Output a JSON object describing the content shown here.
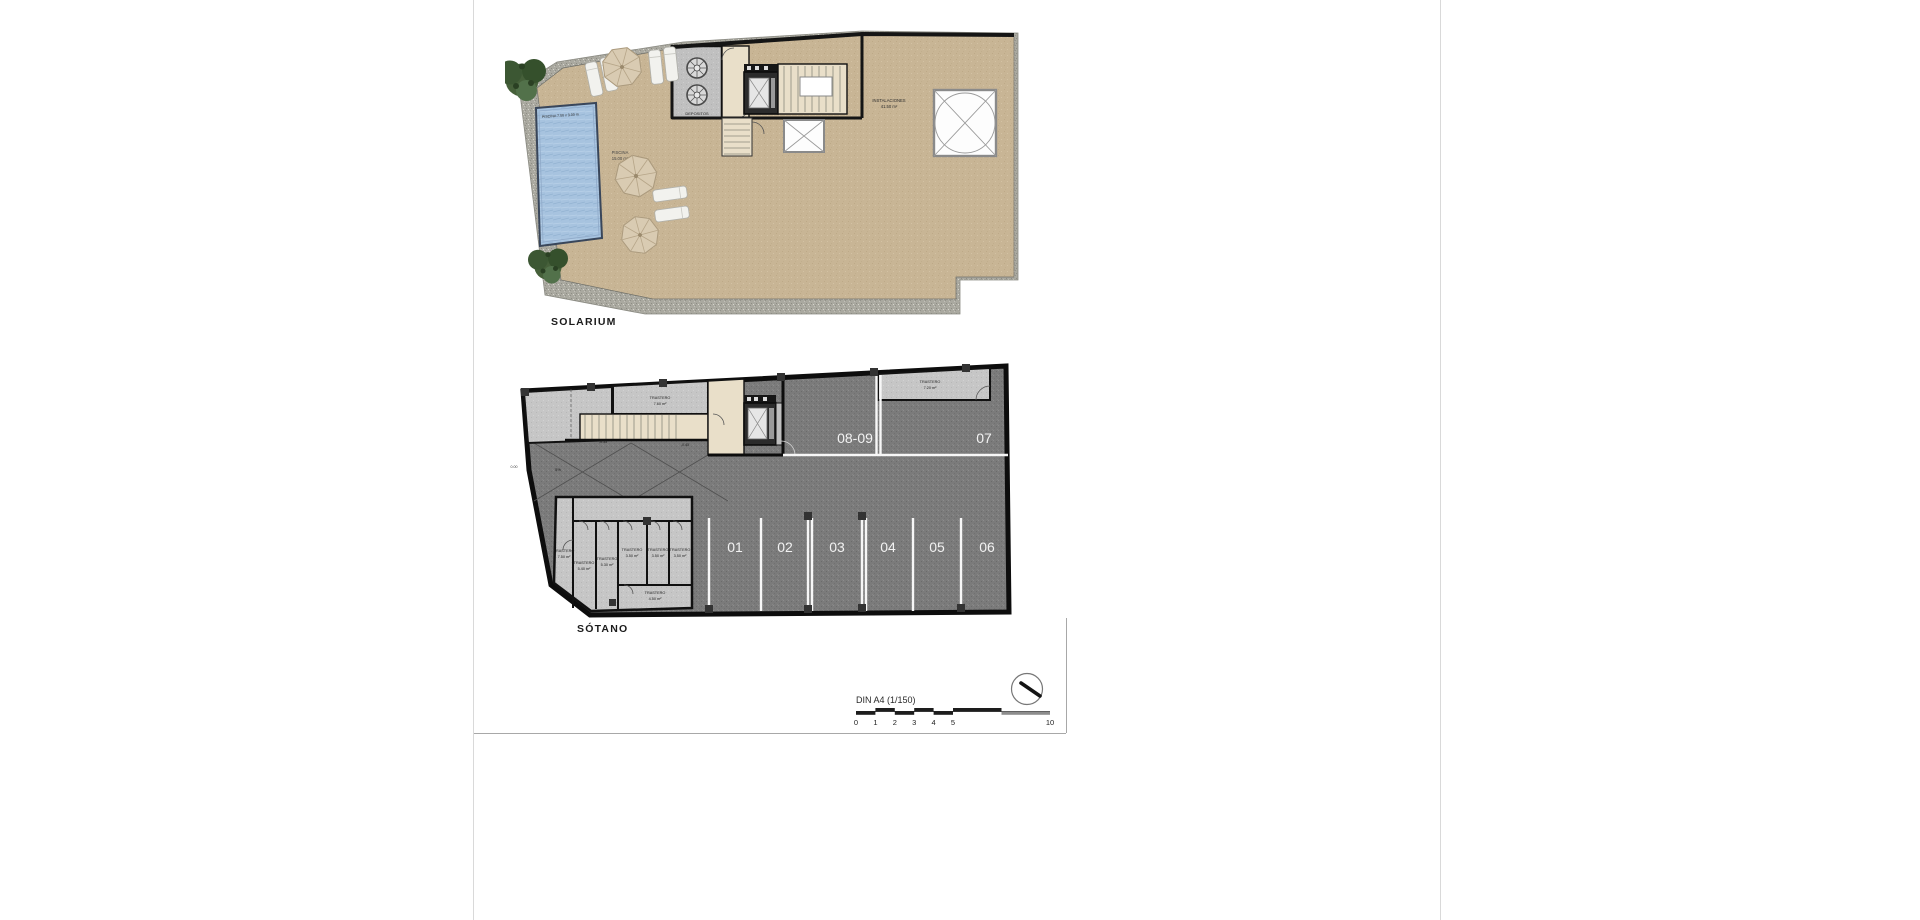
{
  "titles": {
    "solarium": "SOLARIUM",
    "sotano": "SÓTANO"
  },
  "solarium": {
    "pool_dim": "PISCINA 7.00 x 3.00 m",
    "pool_name": "PISCINA",
    "pool_area": "15.00 m²",
    "depositos": "DEPOSITOS",
    "instalaciones_name": "INSTALACIONES",
    "instalaciones_area": "41.50 m²"
  },
  "sotano": {
    "parking_top": [
      "08-09",
      "07"
    ],
    "parking": [
      "01",
      "02",
      "03",
      "04",
      "05",
      "06"
    ],
    "levels": {
      "l0": "0.00",
      "l35": "-0.35",
      "l45": "-0.45",
      "slope": "5%"
    },
    "rooms": {
      "t760": {
        "n": "TRASTERO",
        "a": "7.60 m²"
      },
      "t720": {
        "n": "TRASTERO",
        "a": "7.20 m²"
      },
      "t750": {
        "n": "TRASTERO",
        "a": "7.50 m²"
      },
      "t540": {
        "n": "TRASTERO",
        "a": "5.40 m²"
      },
      "t530": {
        "n": "TRASTERO",
        "a": "5.30 m²"
      },
      "t350a": {
        "n": "TRASTERO",
        "a": "3.50 m²"
      },
      "t350b": {
        "n": "TRASTERO",
        "a": "3.50 m²"
      },
      "t350c": {
        "n": "TRASTERO",
        "a": "3.50 m²"
      },
      "t450": {
        "n": "TRASTERO",
        "a": "4.50 m²"
      }
    }
  },
  "footer": {
    "scale_label": "DIN A4 (1/150)",
    "ticks": [
      "0",
      "1",
      "2",
      "3",
      "4",
      "5",
      "10"
    ]
  },
  "colors": {
    "terrace_tan": "#c8b595",
    "garage_gray": "#7b7b7b",
    "pool_blue": "#a7c3df",
    "interior_beige": "#e9dfc9",
    "room_lightgray": "#c7c7c7",
    "wall_black": "#111111",
    "stall_line_white": "#f7f7f7"
  }
}
